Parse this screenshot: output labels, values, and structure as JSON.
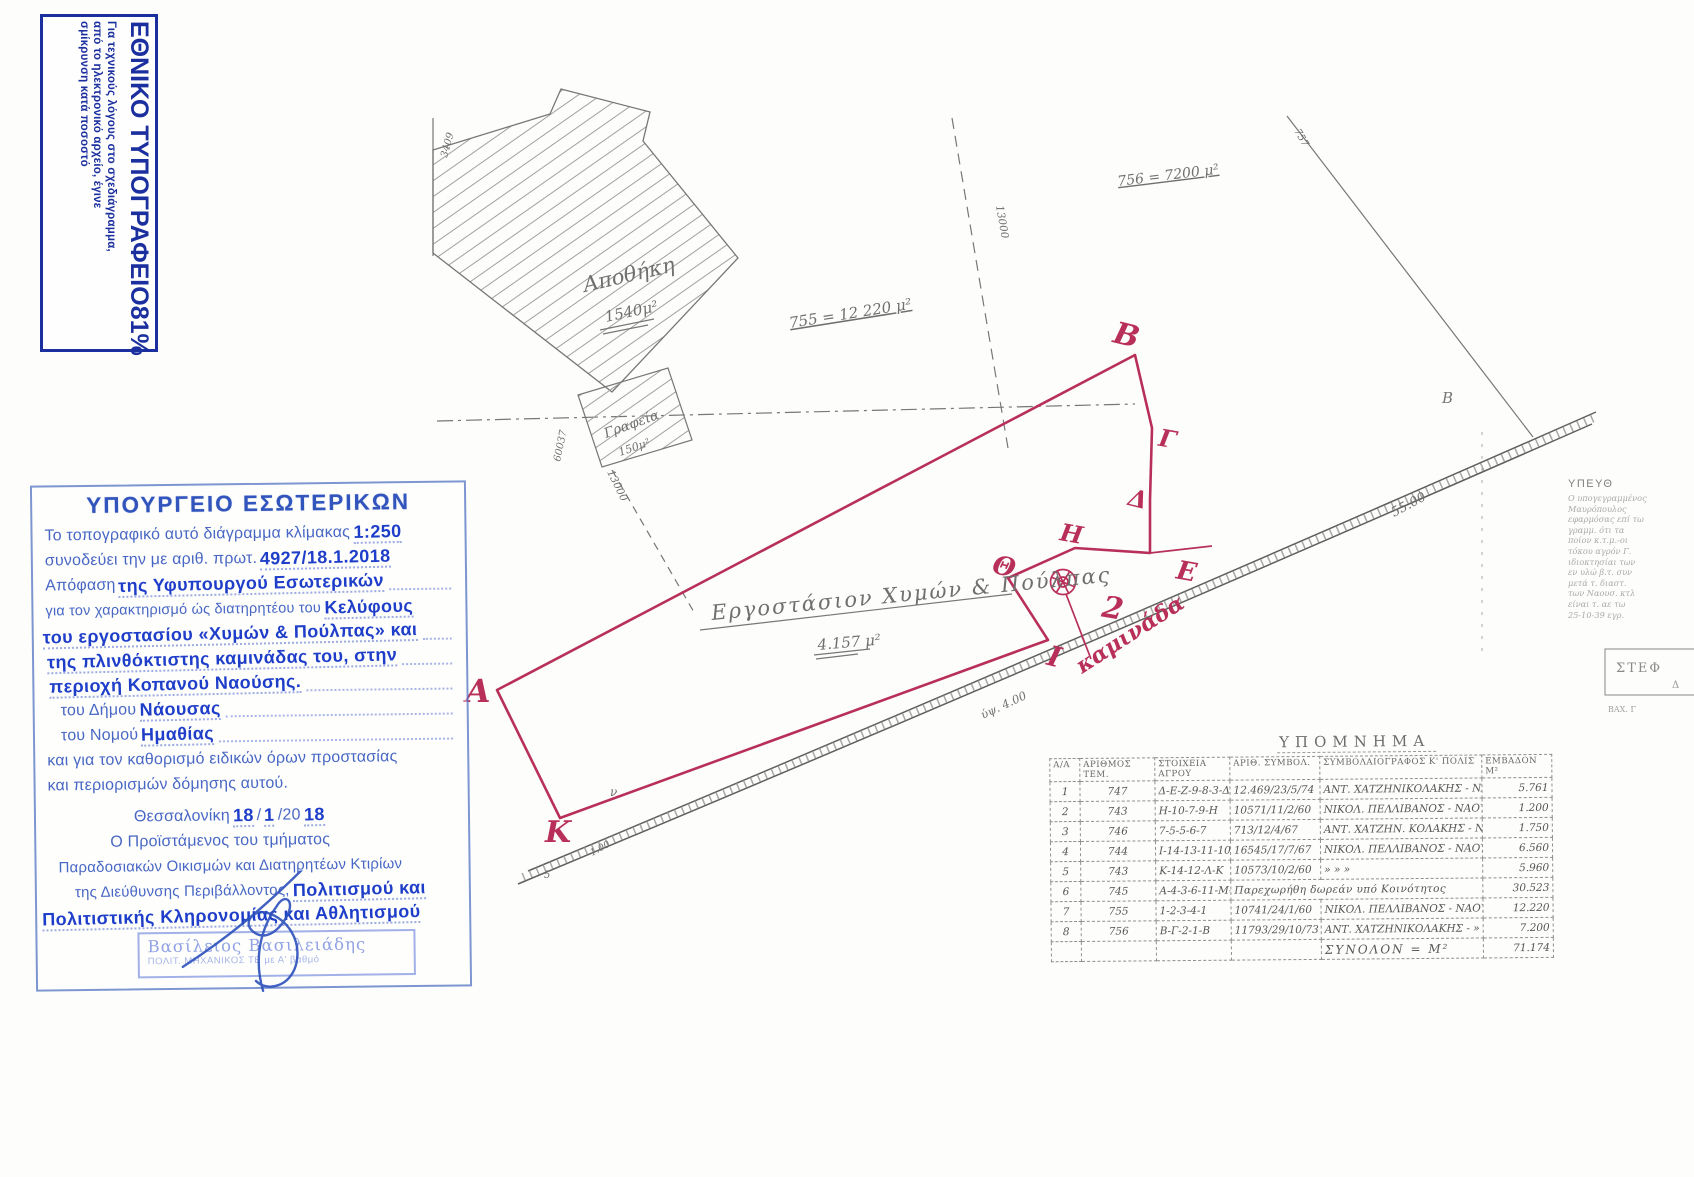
{
  "colors": {
    "red": "#b8305a",
    "blue_stamp": "#1b2f9e",
    "blue_ink": "#2f55b5",
    "blue_hand": "#1e3ec9",
    "pencil": "#6b6b6b"
  },
  "np_stamp": {
    "title": "ΕΘΝΙΚΟ ΤΥΠΟΓΡΑΦΕΙΟ",
    "body": "Για τεχνικούς λόγους στο σχεδιάγραμμα,\nαπό το ηλεκτρονικό αρχείο, έγινε\nσμίκρυνση κατά ποσοστό",
    "percent": "81%"
  },
  "ministry_stamp": {
    "title": "ΥΠΟΥΡΓΕΙΟ ΕΣΩΤΕΡΙΚΩΝ",
    "l1p": "Το τοπογραφικό αυτό διάγραμμα κλίμακας",
    "l1h": "1:250",
    "l2p": "συνοδεύει την με αριθ. πρωτ.",
    "l2h": "4927/18.1.2018",
    "l3p": "Απόφαση",
    "l3h": "της Υφυπουργού Εσωτερικών",
    "l4p": "για τον χαρακτηρισμό ώς διατηρητέου του",
    "l4h": "Κελύφους",
    "l5h": "του εργοστασίου «Χυμών & Πούλπας» και",
    "l6h": "της πλινθόκτιστης καμινάδας του, στην",
    "l7h": "περιοχή Κοπανού Ναούσης.",
    "l8p": "του  Δήμου",
    "l8h": "Νάουσας",
    "l9p": "του  Νομού",
    "l9h": "Ημαθίας",
    "l10p": "και για τον καθορισμό ειδικών όρων προστασίας",
    "l11p": "και περιορισμών δόμησης αυτού.",
    "l12p": "Θεσσαλονίκη",
    "l12h1": "18",
    "l12s1": "/",
    "l12h2": "1",
    "l12s2": "/20",
    "l12h3": "18",
    "l13p": "Ο Προϊστάμενος του τμήματος",
    "l14p": "Παραδοσιακών Οικισμών και Διατηρητέων Κτιρίων",
    "l15p": "της Διεύθυνσης Περιβάλλοντος,",
    "l15h": "Πολιτισμού και",
    "l16h": "Πολιτιστικής Κληρονομίας και Αθλητισμού",
    "sig_name": "Βασίλειος Βασιλειάδης",
    "sig_role": "ΠΟΛΙΤ. ΜΗΧΑΝΙΚΟΣ ΤΕ με Α' βαθμό"
  },
  "drawing": {
    "labels": {
      "apothiki": "Αποθήκη",
      "apothiki_area": "1540μ²",
      "grafeia": "Γραφεία",
      "grafeia_area": "150μ²",
      "plot755": "755 = 12 220 μ²",
      "plot756": "756 = 7200 μ²",
      "plot757": "757",
      "dim13000a": "13000",
      "dim13000b": "13000",
      "dim60037": "60037",
      "dim3409": "3409",
      "dim55": "55.00",
      "pointB": "B",
      "factory": "Εργοστάσιον  Χυμών & Πούλπας",
      "factory_area": "4.157 μ²",
      "height_mark": "ύψ. 4.00",
      "mark_v": "ν",
      "mark_5": "5",
      "mark_100": "1.00"
    },
    "red": {
      "A": "Α",
      "B": "Β",
      "G": "Γ",
      "D": "Δ",
      "E": "Ε",
      "H": "Η",
      "TH": "Θ",
      "I": "Ι",
      "K": "Κ",
      "two": "2",
      "kaminada": "καμινάδα"
    }
  },
  "legend": {
    "title": "ΥΠΟΜΝΗΜΑ",
    "headers": [
      "Α/Α",
      "ΑΡΙΘΜΟΣ ΤΕΜ.",
      "ΣΤΟΙΧΕΙΑ\nΑΓΡΟΥ",
      "ΑΡΙΘ. ΣΥΜΒΟΛ.",
      "ΣΥΜΒΟΛΑΙΟΓΡΑΦΟΣ Κ' ΠΟΛΙΣ",
      "ΕΜΒΑΔΟΝ Μ²"
    ],
    "rows": [
      [
        "1",
        "747",
        "Δ-Ε-Ζ-9-8-3-Δ",
        "12.469/23/5/74",
        "ΑΝΤ. ΧΑΤΖΗΝΙΚΟΛΑΚΗΣ - ΝΑΟΥΣΑ",
        "5.761"
      ],
      [
        "2",
        "743",
        "Η-10-7-9-Η",
        "10571/11/2/60",
        "ΝΙΚΟΛ. ΠΕΛΛΙΒΑΝΟΣ - ΝΑΟΥΣΑ",
        "1.200"
      ],
      [
        "3",
        "746",
        "7-5-5-6-7",
        "713/12/4/67",
        "ΑΝΤ. ΧΑΤΖΗΝ. ΚΟΛΑΚΗΣ - ΝΑΟΥΣΑ",
        "1.750"
      ],
      [
        "4",
        "744",
        "Ι-14-13-11-10-Θ-Ι",
        "16545/17/7/67",
        "ΝΙΚΟΛ. ΠΕΛΛΙΒΑΝΟΣ - ΝΑΟΥΣΑ",
        "6.560"
      ],
      [
        "5",
        "743",
        "Κ-14-12-Λ-Κ",
        "10573/10/2/60",
        "»          »          »",
        "5.960"
      ],
      [
        "6",
        "745",
        "Α-4-3-6-11-Μ-Α",
        "Παρεχωρήθη δωρεάν υπό Κοινότητος",
        "30.523"
      ],
      [
        "7",
        "755",
        "1-2-3-4-1",
        "10741/24/1/60",
        "ΝΙΚΟΛ. ΠΕΛΛΙΒΑΝΟΣ - ΝΑΟΥΣΑ",
        "12.220"
      ],
      [
        "8",
        "756",
        "Β-Γ-2-1-Β",
        "11793/29/10/73",
        "ΑΝΤ. ΧΑΤΖΗΝΙΚΟΛΑΚΗΣ -   »",
        "7.200"
      ]
    ],
    "total_label": "ΣΥΝΟΛΟΝ  =  Μ²",
    "total_value": "71.174"
  },
  "right_notes": {
    "heading": "ΥΠΕΥΘ",
    "body": "Ο υπογεγραμμένος\nΜαυρόπουλος\nεφαρμόσας επί τω\nγραμμ. ότι τα\nποίον κ.τ.μ.-οι\nτόκου αγρόν Γ.\nιδιοκτησίαι των\nεν υλώ β.τ. συν\nμετά τ. διαστ.\nτων Ναουσ. κτλ\nείναι τ. αε τω\n25-10-39 εγρ.",
    "box_label": "ΣΤΕΦ",
    "box_d": "Δ",
    "box_sub": "ΒΑΧ. Γ"
  }
}
